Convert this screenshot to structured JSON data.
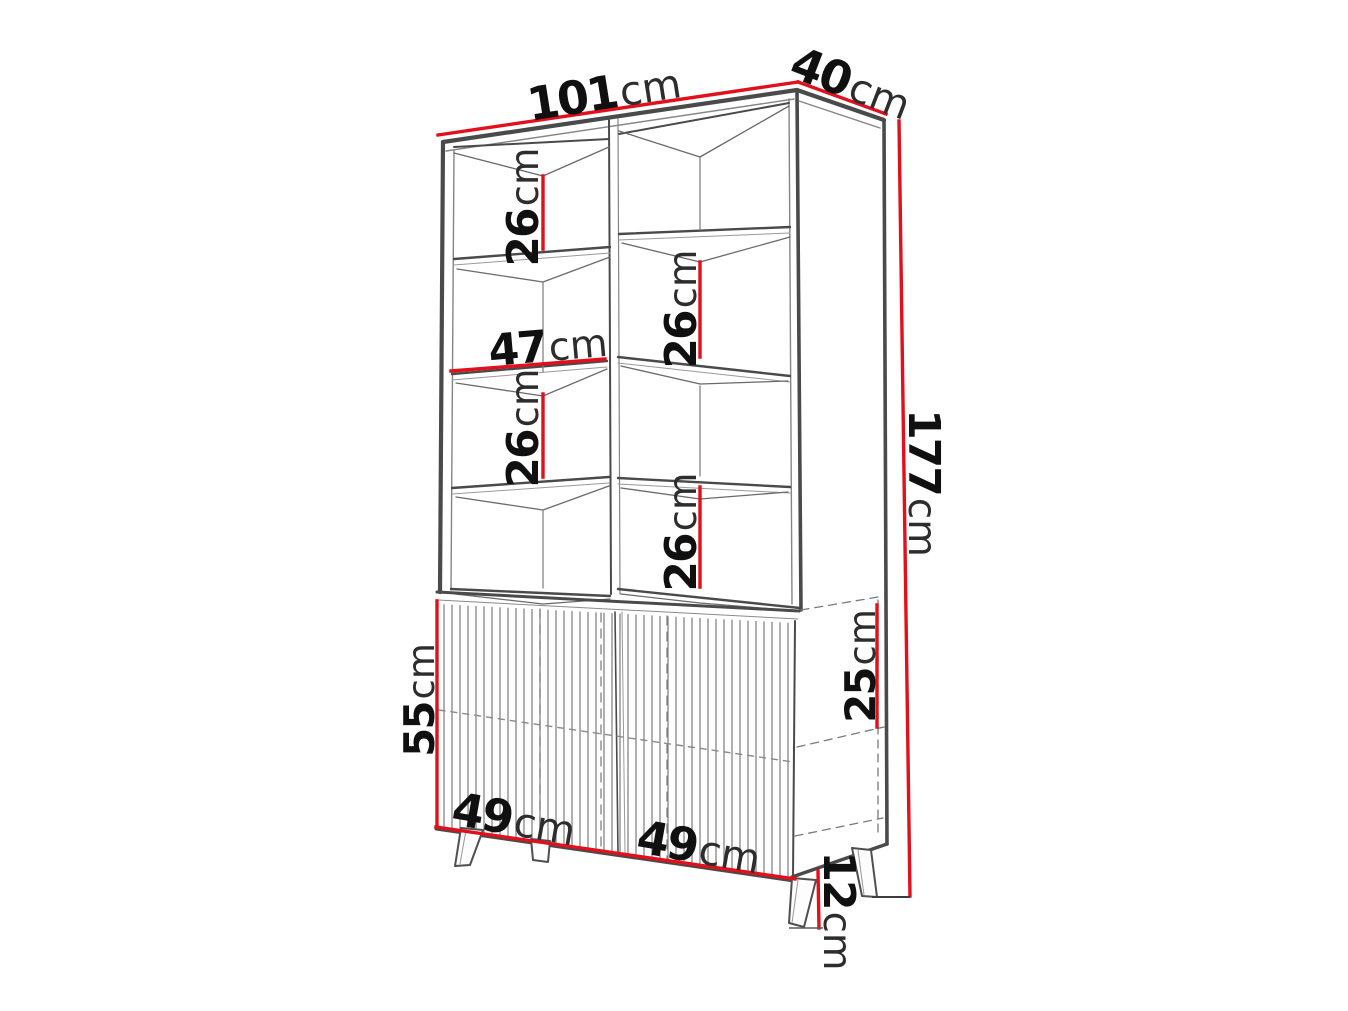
{
  "diagram": {
    "type": "furniture dimension drawing",
    "subject": "tall display cabinet: open shelving on top, fluted two-door base cabinet on splayed legs",
    "unit": "cm",
    "accent_color": "#e30f1a",
    "line_color": "#4a4a4a",
    "labels": {
      "width_top": {
        "value": "101",
        "unit": "cm"
      },
      "depth_top": {
        "value": "40",
        "unit": "cm"
      },
      "total_height": {
        "value": "177",
        "unit": "cm"
      },
      "shelf_gap_left_upper": {
        "value": "26",
        "unit": "cm"
      },
      "shelf_gap_right_upper": {
        "value": "26",
        "unit": "cm"
      },
      "inner_shelf_width": {
        "value": "47",
        "unit": "cm"
      },
      "shelf_gap_left_lower": {
        "value": "26",
        "unit": "cm"
      },
      "shelf_gap_right_lower": {
        "value": "26",
        "unit": "cm"
      },
      "base_height": {
        "value": "55",
        "unit": "cm"
      },
      "base_compartment_height": {
        "value": "25",
        "unit": "cm"
      },
      "door_width_left": {
        "value": "49",
        "unit": "cm"
      },
      "door_width_right": {
        "value": "49",
        "unit": "cm"
      },
      "leg_height": {
        "value": "12",
        "unit": "cm"
      }
    }
  }
}
